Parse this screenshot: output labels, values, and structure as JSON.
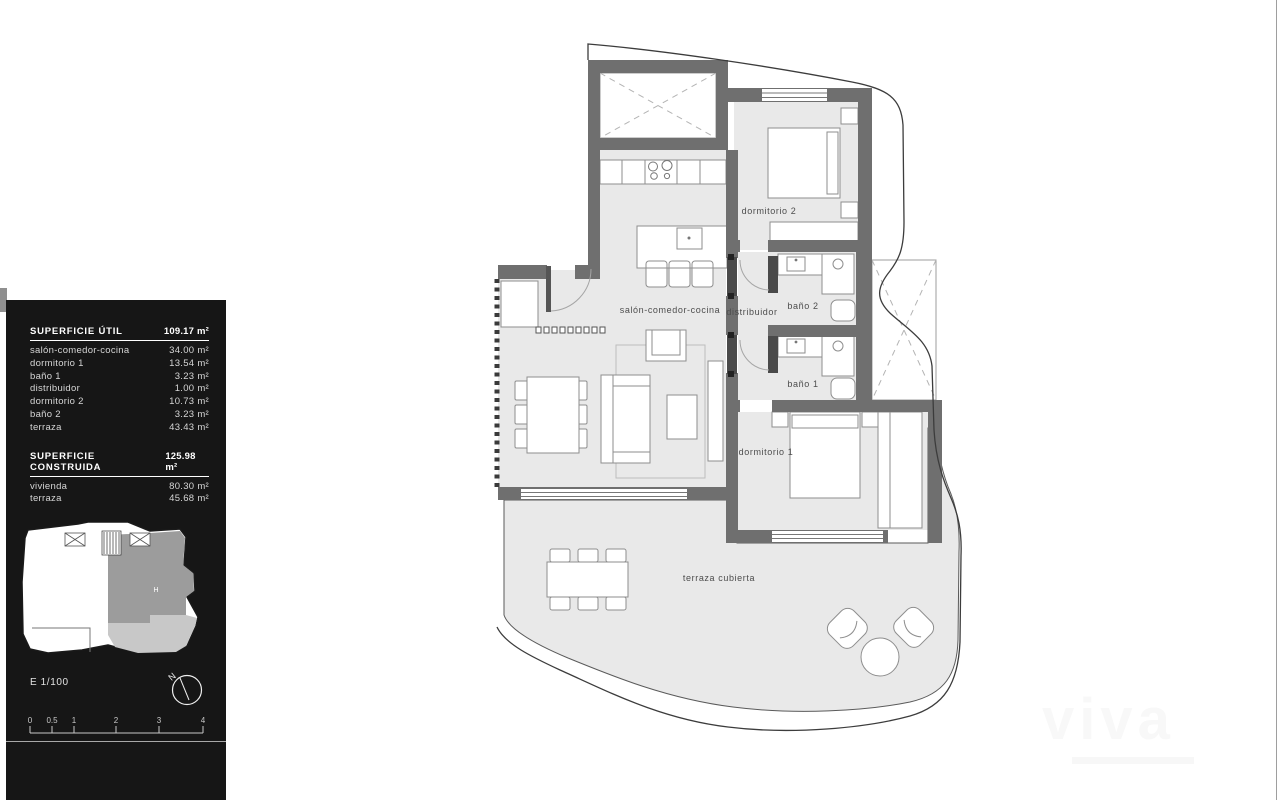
{
  "panel": {
    "superficie_util": {
      "title": "SUPERFICIE ÚTIL",
      "total": "109.17 m²",
      "rows": [
        {
          "label": "salón-comedor-cocina",
          "value": "34.00 m²"
        },
        {
          "label": "dormitorio 1",
          "value": "13.54 m²"
        },
        {
          "label": "baño 1",
          "value": "3.23 m²"
        },
        {
          "label": "distribuidor",
          "value": "1.00 m²"
        },
        {
          "label": "dormitorio 2",
          "value": "10.73 m²"
        },
        {
          "label": "baño 2",
          "value": "3.23 m²"
        },
        {
          "label": "terraza",
          "value": "43.43 m²"
        }
      ]
    },
    "superficie_construida": {
      "title": "SUPERFICIE CONSTRUIDA",
      "total": "125.98 m²",
      "rows": [
        {
          "label": "vivienda",
          "value": "80.30 m²"
        },
        {
          "label": "terraza",
          "value": "45.68 m²"
        }
      ]
    },
    "scale_label": "E 1/100",
    "north_label": "N",
    "key_plan": {
      "unit_label": "H",
      "unit_color": "#9c9c9c",
      "terrace_color": "#c8c8c8"
    },
    "scale_ticks": [
      "0",
      "0.5",
      "1",
      "2",
      "3",
      "4"
    ],
    "panel_bg": "#161616"
  },
  "plan": {
    "labels": {
      "salon": "salón-comedor-cocina",
      "distribuidor": "distribuidor",
      "bano2": "baño 2",
      "bano1": "baño 1",
      "dormitorio2": "dormitorio 2",
      "dormitorio1": "dormitorio 1",
      "terraza": "terraza cubierta"
    },
    "colors": {
      "wall": "#6f6f6f",
      "floor": "#e9e9e9",
      "boundary": "#3c3c3c"
    }
  },
  "watermark": {
    "text": "viva"
  }
}
